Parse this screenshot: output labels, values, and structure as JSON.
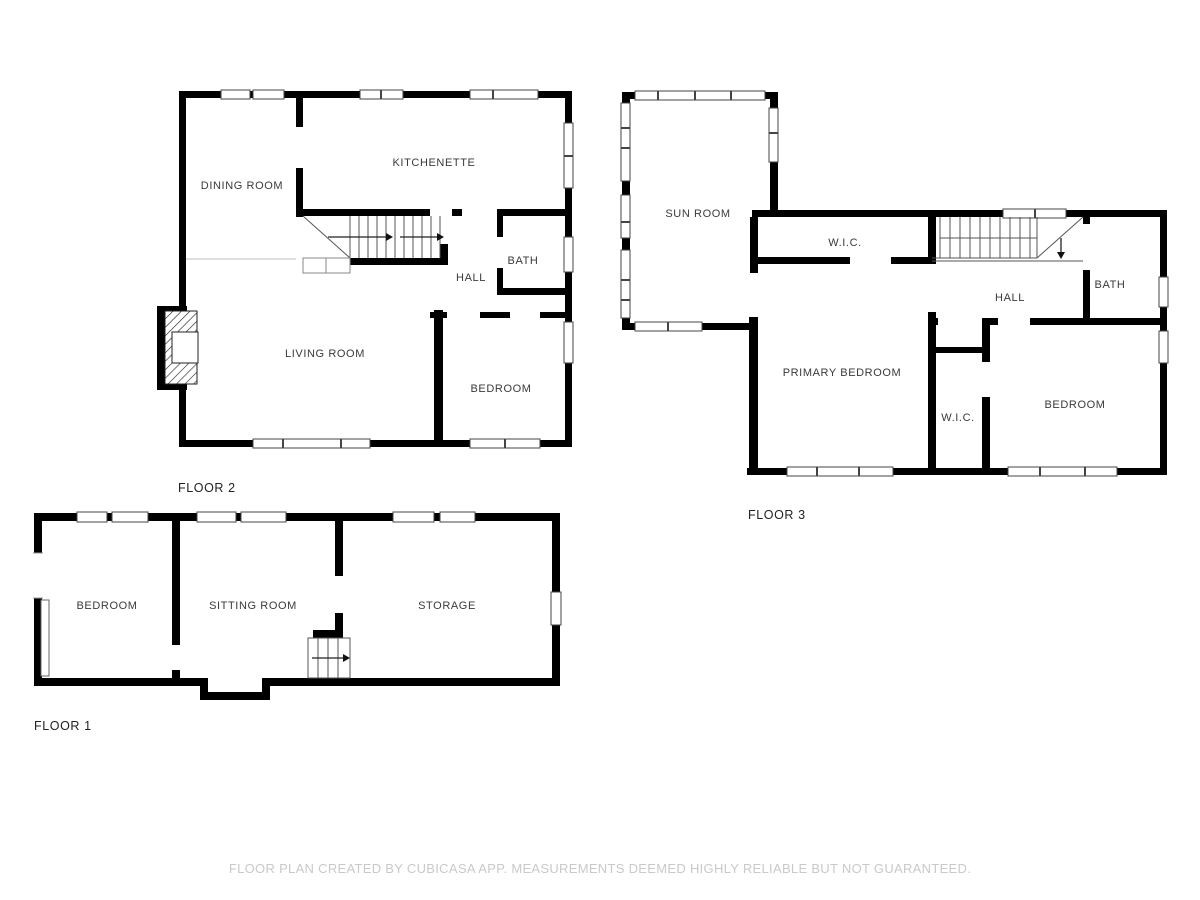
{
  "title": "Floor plan",
  "colors": {
    "wall": "#000000",
    "room_label": "#3a3a3a",
    "floor_label": "#222222",
    "footer_text": "#c9c9c9",
    "background": "#ffffff"
  },
  "floor2": {
    "label": "FLOOR 2",
    "rooms": {
      "dining": "DINING ROOM",
      "kitchenette": "KITCHENETTE",
      "hall": "HALL",
      "bath": "BATH",
      "living": "LIVING ROOM",
      "bedroom": "BEDROOM"
    }
  },
  "floor3": {
    "label": "FLOOR 3",
    "rooms": {
      "sunroom": "SUN ROOM",
      "wic_top": "W.I.C.",
      "hall": "HALL",
      "bath": "BATH",
      "primary": "PRIMARY BEDROOM",
      "wic_bottom": "W.I.C.",
      "bedroom": "BEDROOM"
    }
  },
  "floor1": {
    "label": "FLOOR 1",
    "rooms": {
      "bedroom": "BEDROOM",
      "sitting": "SITTING ROOM",
      "storage": "STORAGE"
    }
  },
  "footer": {
    "disclaimer": "FLOOR PLAN CREATED BY CUBICASA APP. MEASUREMENTS DEEMED HIGHLY RELIABLE BUT NOT GUARANTEED."
  }
}
